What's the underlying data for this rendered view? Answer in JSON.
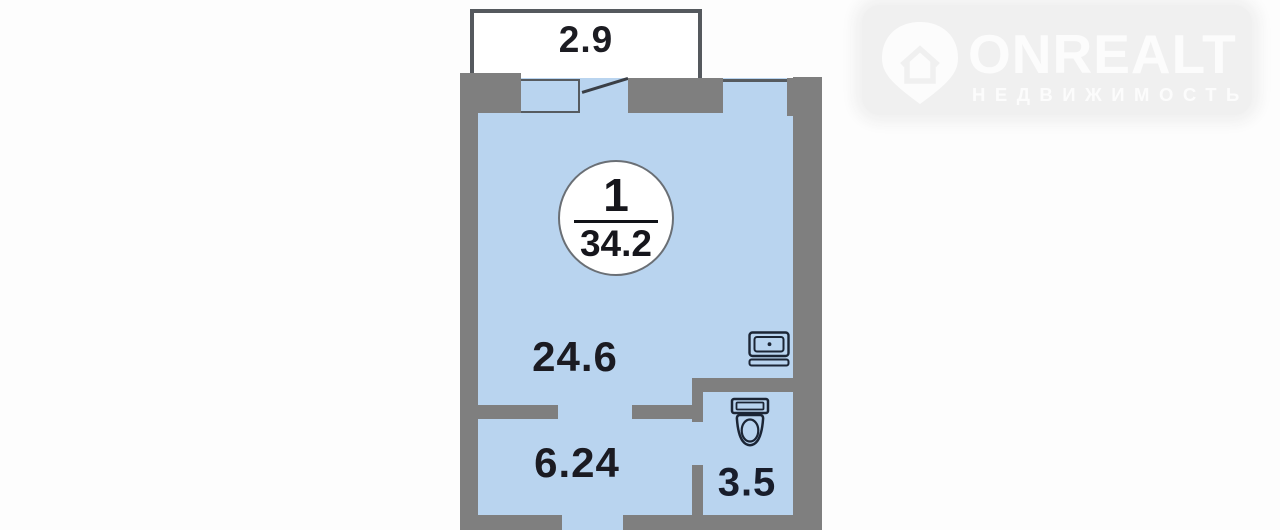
{
  "watermark": {
    "brand": "ONREALT",
    "subtitle": "НЕДВИЖИМОСТЬ",
    "icon": "house-location-pin-icon",
    "color": "#fcfcfc"
  },
  "floorplan": {
    "unit_badge": {
      "rooms_count": "1",
      "total_area": "34.2"
    },
    "balcony": {
      "area": "2.9"
    },
    "rooms": [
      {
        "name": "living-room",
        "area": "24.6"
      },
      {
        "name": "hallway",
        "area": "6.24"
      },
      {
        "name": "bathroom",
        "area": "3.5"
      }
    ],
    "fixtures": [
      "sink-icon",
      "toilet-icon"
    ],
    "colors": {
      "floor": "#b9d4ef",
      "wall": "#7f7f7f",
      "balcony_border": "#55595e",
      "label_text": "#1b1b22",
      "fixture_stroke": "#1b2535",
      "page_background": "#fdfdfd",
      "watermark_plate": "#f0f0f0"
    }
  }
}
